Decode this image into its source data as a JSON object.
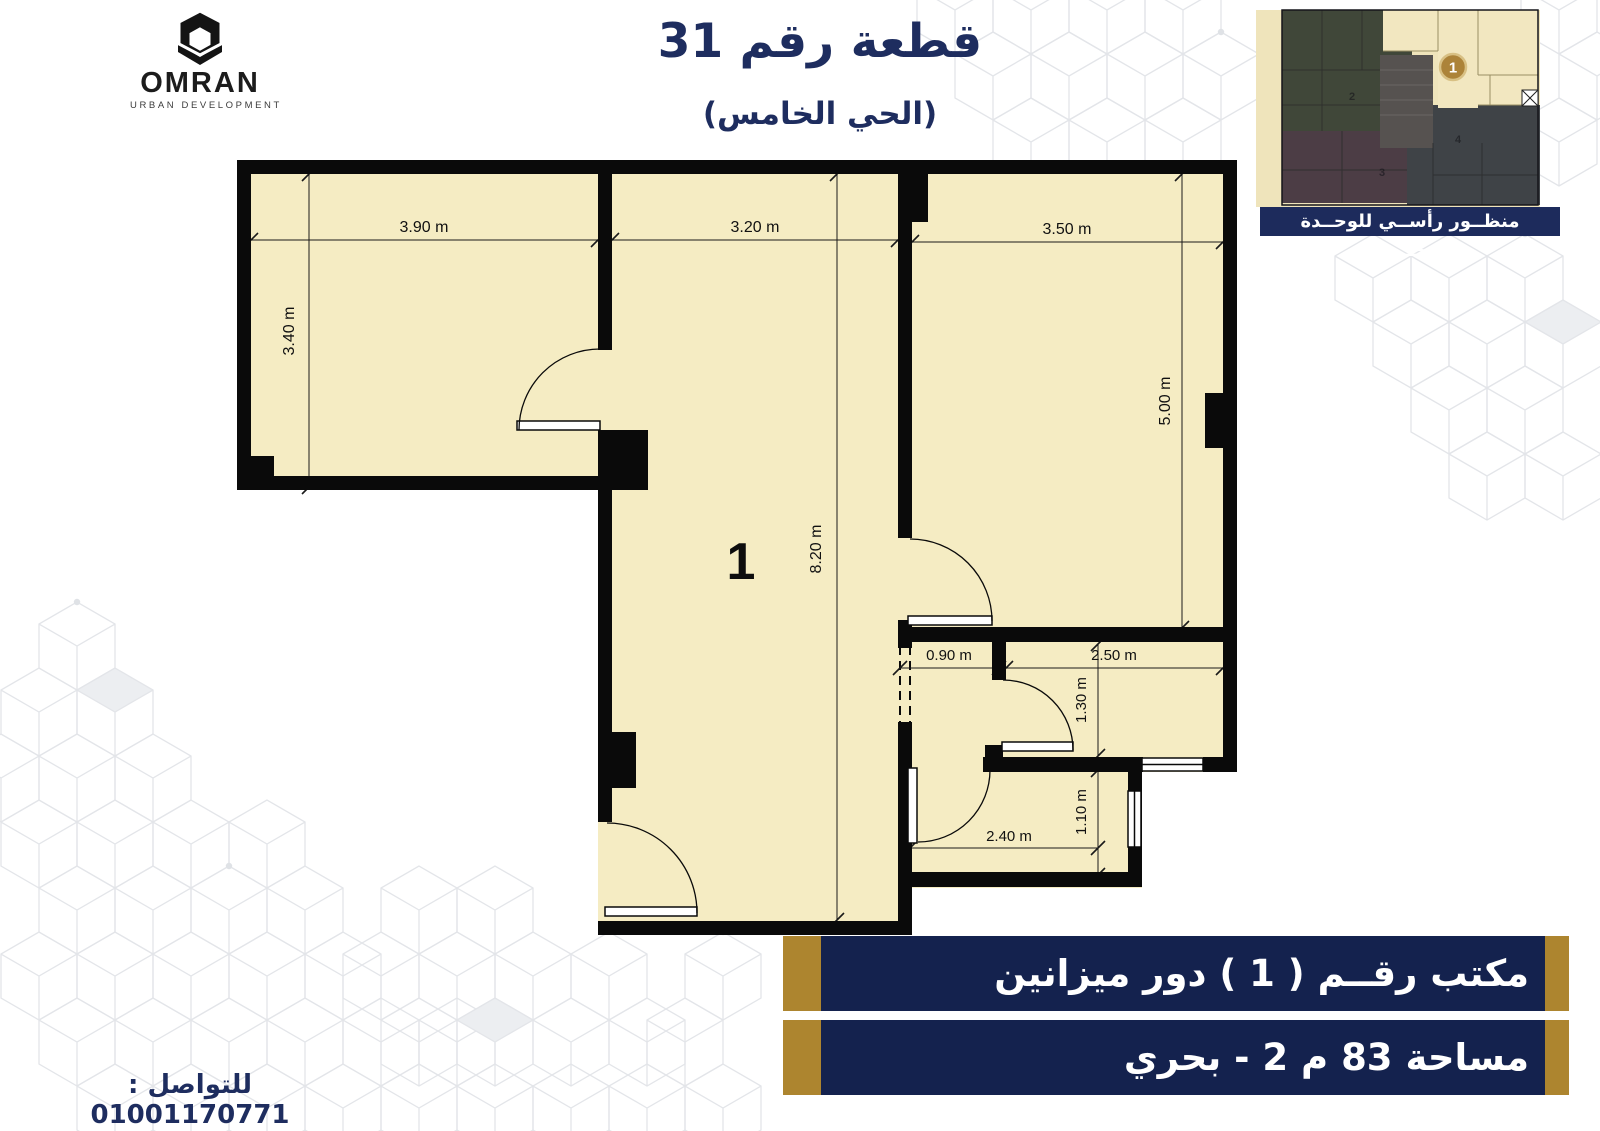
{
  "brand": {
    "name": "OMRAN",
    "tagline": "URBAN DEVELOPMENT"
  },
  "header": {
    "title": "قطعة رقم 31",
    "subtitle": "(الحي الخامس)"
  },
  "minimap": {
    "caption": "منظــور رأســي للوحــدة المحـــددة",
    "selected_unit_badge": "1",
    "other_unit_labels": [
      "2",
      "3",
      "4"
    ]
  },
  "plan": {
    "unit_label": "1",
    "dimensions": {
      "left_room_width": "3.90 m",
      "left_room_height": "3.40 m",
      "hall_width": "3.20 m",
      "right_room_width": "3.50 m",
      "right_room_height": "5.00 m",
      "hall_height": "8.20 m",
      "corridor_width": "0.90 m",
      "bath_width": "2.50 m",
      "bath_height": "1.30 m",
      "kitchen_width": "2.40 m",
      "kitchen_height": "1.10 m"
    }
  },
  "info_bars": [
    {
      "label": "مكتب رقــم ( 1 ) دور ميزانين"
    },
    {
      "label": "مساحة 83 م 2 - بحري"
    }
  ],
  "contact": {
    "label": "للتواصل : 01001170771"
  },
  "colors": {
    "navy": "#1e2d5f",
    "bar_navy": "#14224e",
    "gold": "#ad852f",
    "plan_fill": "#f5ecc3",
    "wall": "#0a0a0a"
  }
}
